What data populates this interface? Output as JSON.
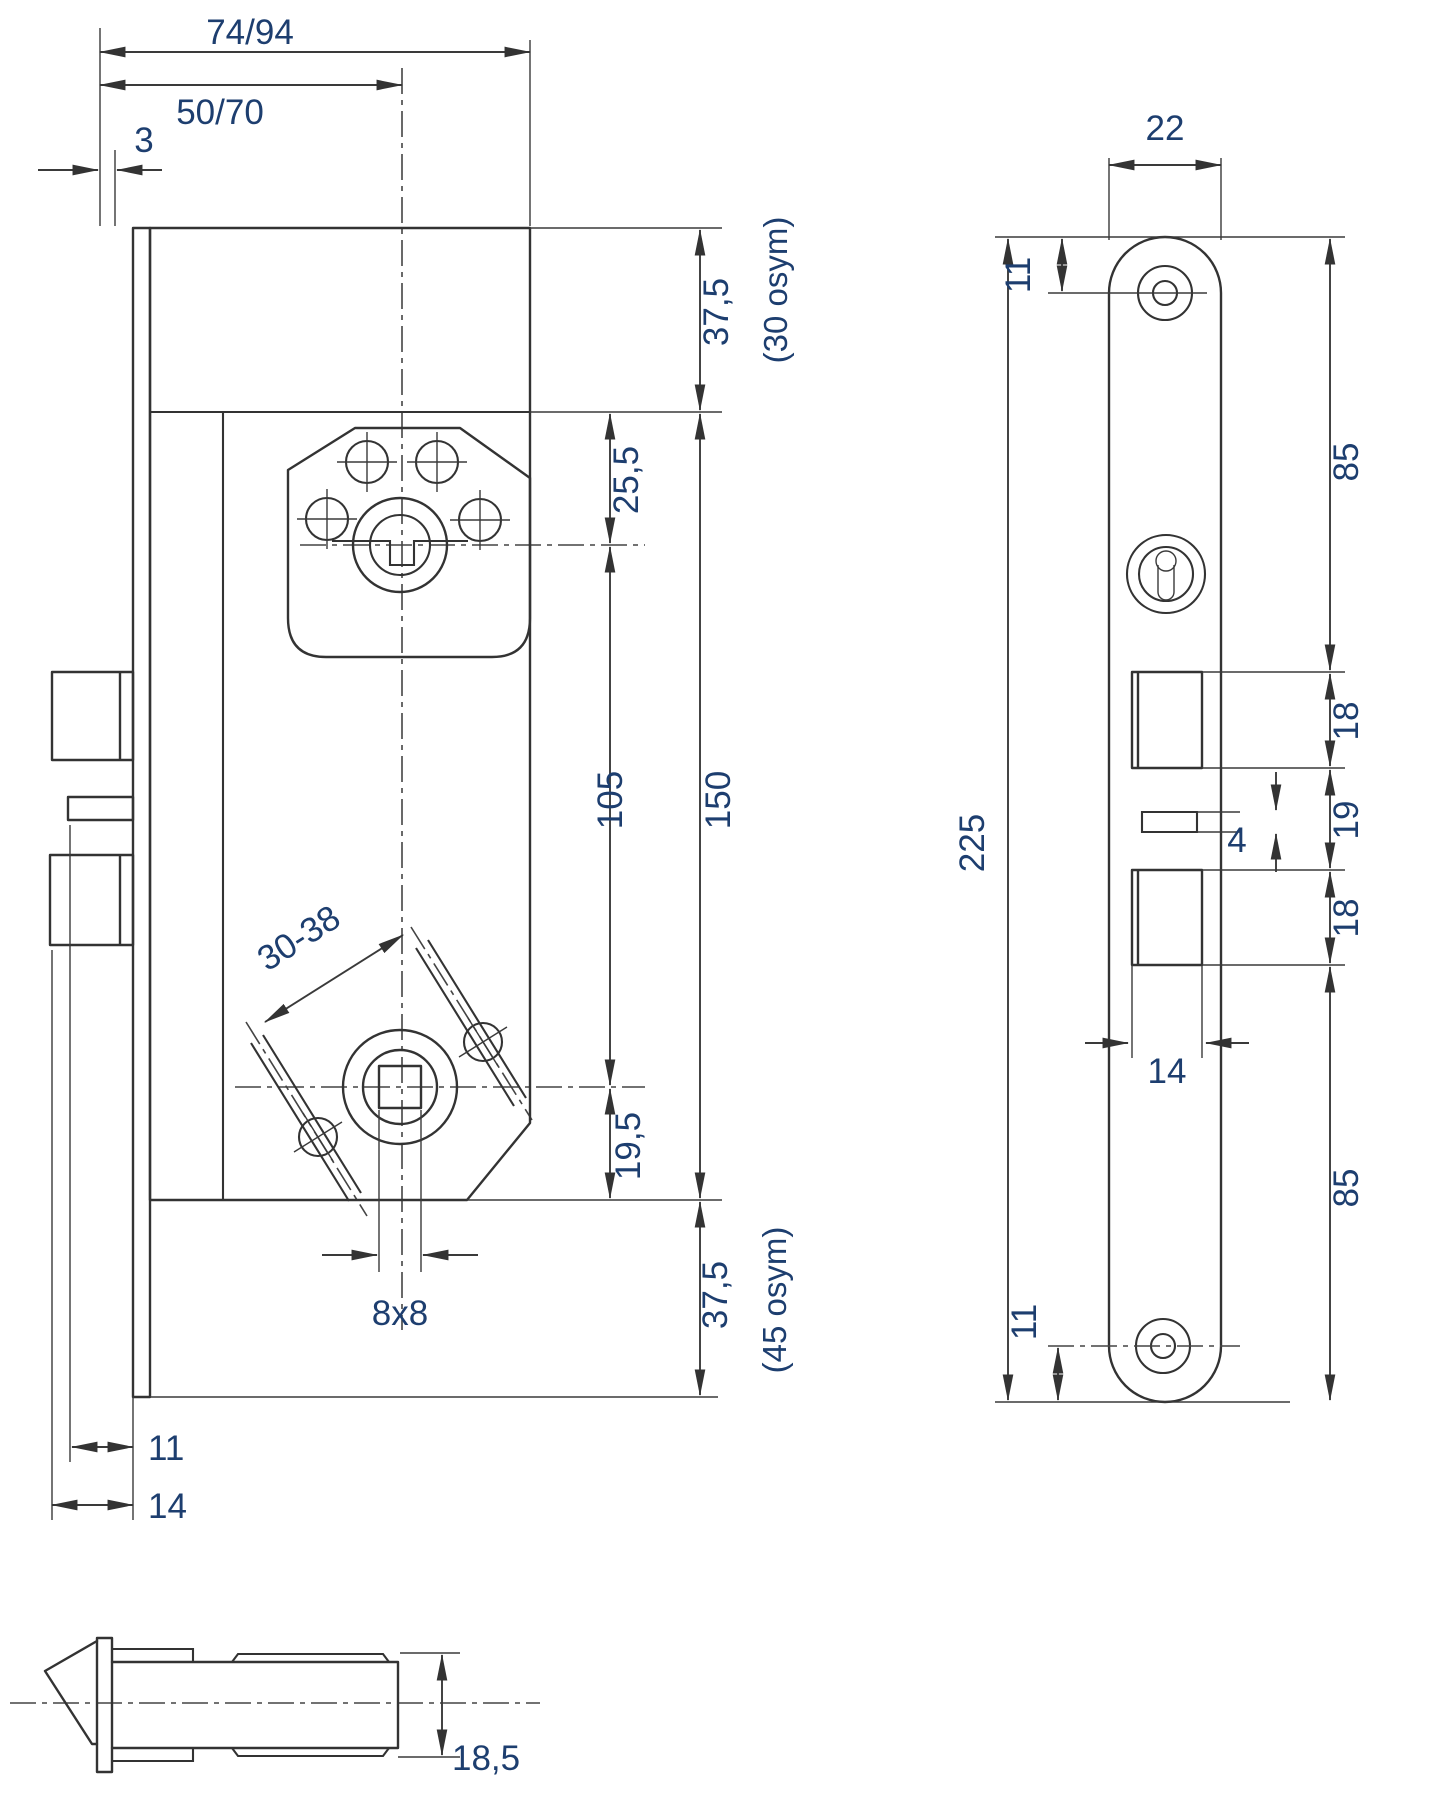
{
  "meta": {
    "background": "#ffffff",
    "line_color": "#333333",
    "dimension_text_color": "#1d3e6f",
    "drawing_type": "mortise lock dimensional drawing"
  },
  "views": {
    "side": {
      "dims": {
        "case_depth": "74/94",
        "backset": "50/70",
        "faceplate_stand_off": "3",
        "top_extension": "37,5",
        "top_extension_alt": "(30 osym)",
        "cylinder_offset": "25,5",
        "cylinder_to_spindle": "105",
        "case_height": "150",
        "spindle_positions": "30-38",
        "spindle_offset_bottom": "19,5",
        "spindle_hole": "8x8",
        "bottom_extension": "37,5",
        "bottom_extension_alt": "(45 osym)",
        "latch_throw": "11",
        "bolt_throw": "14"
      }
    },
    "front": {
      "dims": {
        "faceplate_width": "22",
        "screw_top_offset": "11",
        "faceplate_length": "225",
        "top_to_latch_cutout": "85",
        "latch_cutout_height": "18",
        "aux_slot_height": "4",
        "latch_to_bolt_gap": "19",
        "bolt_cutout_height": "18",
        "cutout_width": "14",
        "bolt_to_bottom": "85",
        "screw_bottom_offset": "11"
      }
    },
    "bottom": {
      "dims": {
        "case_thickness": "18,5"
      }
    }
  }
}
